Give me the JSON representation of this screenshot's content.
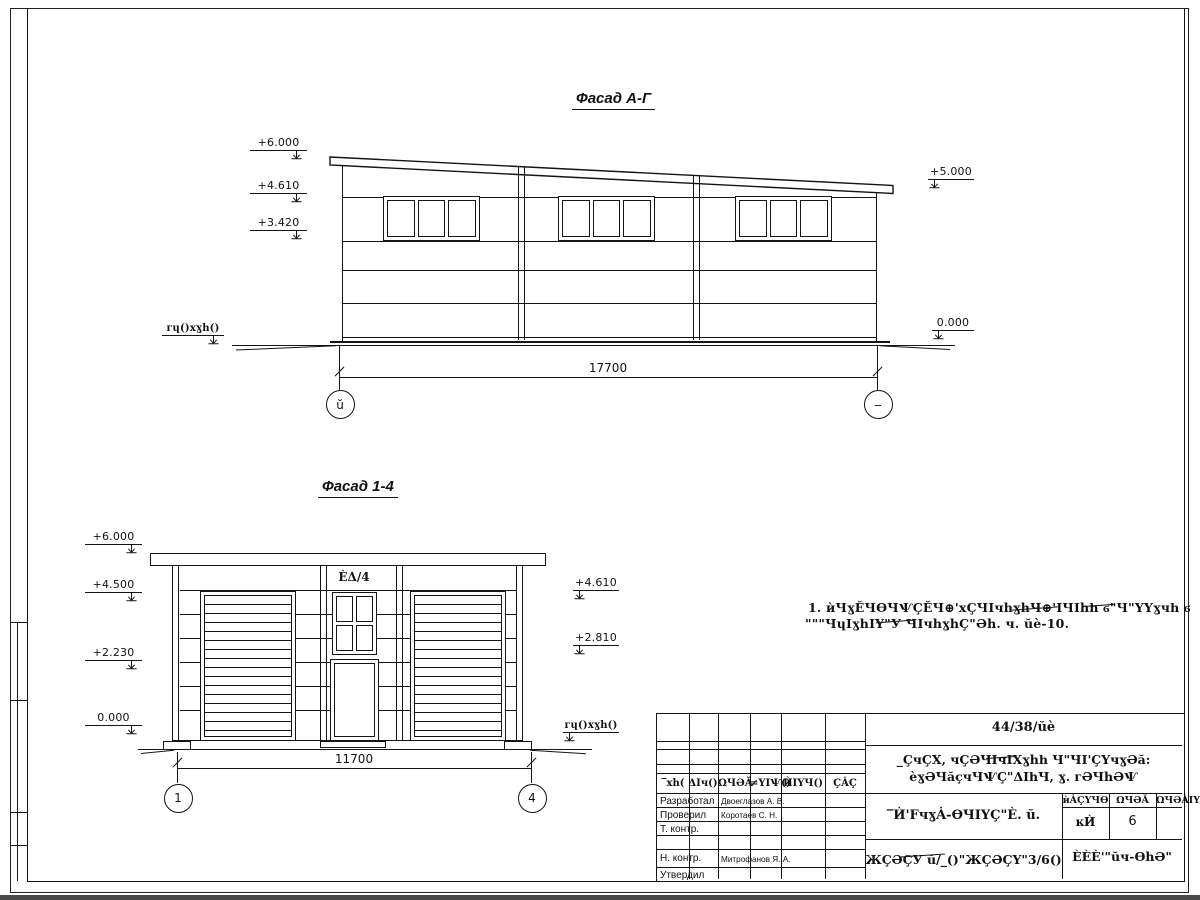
{
  "facade_ag": {
    "title": "Фасад А-Г",
    "elevations_left": [
      "+6.000",
      "+4.610",
      "+3.420"
    ],
    "elevations_right": [
      "+5.000",
      "0.000"
    ],
    "ground_label": "ᴦɥ()xɣh()",
    "dimension": "17700",
    "axis_left": "ŭ",
    "axis_right": "‒"
  },
  "facade_14": {
    "title": "Фасад 1-4",
    "elevations_left": [
      "+6.000",
      "+4.500",
      "+2.230",
      "0.000"
    ],
    "elevations_right": [
      "+4.610",
      "+2.810"
    ],
    "ground_label": "ᴦɥ()xɣh()",
    "window_label": "ÈΔ/4",
    "dimension": "11700",
    "axis_left": "1",
    "axis_right": "4"
  },
  "note": {
    "line1": "1. ѝЧɣĔЧѲЧѰÇĔЧ⊕'xÇЧIчhɣhЧ⊕'IЧIhһ ϭ\"Ч\"ҮҮɣчһ ϭ",
    "line2": "\"\"\"ЧɥIɣhIҮ\"У ЧIчhɣhÇ\"Əh. ч. ŭè-10."
  },
  "title_block": {
    "doc_number": "44/38/ŭè",
    "title_line1": "_ÇчÇХ, чÇƏЧIчIХɣhһ Ч\"ЧI'ÇҮчɣƏă:",
    "title_line2": "èɣƏЧăçчЧѰÇ\"ΔIһЧ, ɣ. ᴦƏЧhƏѰ",
    "code": "‾Ѝ'FчɣȦ-ѲЧIҮÇ\"È. ŭ.",
    "header_cols": [
      "‾хh(",
      "ΔIч()",
      "ΩЧƏĂ",
      "≠ҮIѰ()",
      "ЍIҮЧ()",
      "ÇȦÇ"
    ],
    "rows": [
      {
        "role": "Разработал",
        "name": "Двоеглазов А. В."
      },
      {
        "role": "Проверил",
        "name": "Коротаев С. Н."
      },
      {
        "role": "Т. контр.",
        "name": ""
      },
      {
        "role": "",
        "name": ""
      },
      {
        "role": "Н. контр.",
        "name": "Митрофанов Я. А."
      },
      {
        "role": "Утвердил",
        "name": ""
      }
    ],
    "stamp_headers": [
      "ѝȦÇҮЧѲ",
      "ΩЧƏĂ",
      "ΩЧƏȦIҮ"
    ],
    "stamp_values": [
      "ĸЍ",
      "6",
      ""
    ],
    "bottom_center": "ЖÇƏÇУ ŭ/_()\"ЖÇƏÇҮ\"3/6()",
    "bottom_right": "ÈÈÈ'\"ŭч-ѲhƏ\""
  },
  "colors": {
    "ink": "#141414",
    "paper": "#ffffff",
    "window_edge_bar": "#4a4a4a"
  }
}
